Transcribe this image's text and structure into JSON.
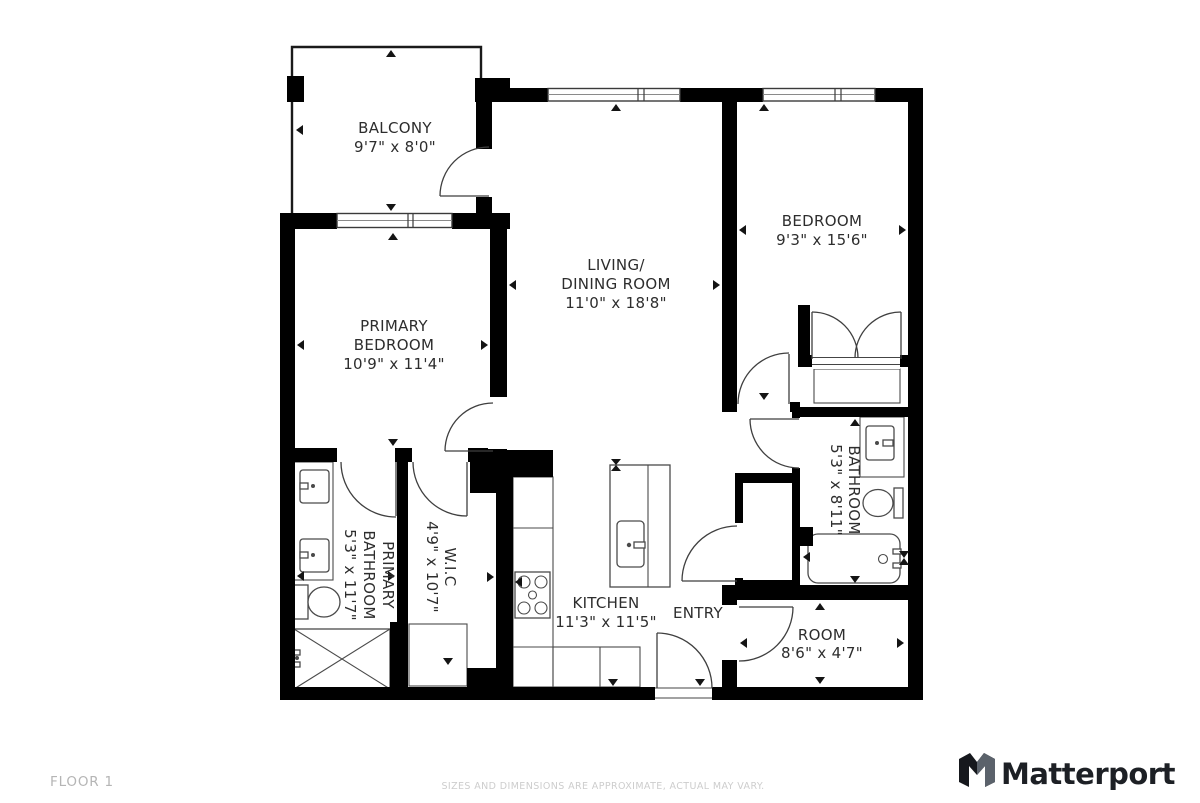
{
  "title": "Floor plan",
  "colors": {
    "background": "#ffffff",
    "wall": "#000000",
    "fixture_line": "#4a4a4a",
    "label": "#2d2d2d",
    "floor_label": "#b5b5b5",
    "disclaimer": "#cdcdcd",
    "brand": "#1d2025"
  },
  "rooms": {
    "balcony": {
      "name": "BALCONY",
      "dims": "9'7\" x 8'0\""
    },
    "primary_bedroom": {
      "line1": "PRIMARY",
      "line2": "BEDROOM",
      "dims": "10'9\" x 11'4\""
    },
    "living_dining": {
      "line1": "LIVING/",
      "line2": "DINING ROOM",
      "dims": "11'0\" x 18'8\""
    },
    "bedroom": {
      "name": "BEDROOM",
      "dims": "9'3\" x 15'6\""
    },
    "bathroom": {
      "name": "BATHROOM",
      "dims": "5'3\" x 8'11\""
    },
    "primary_bathroom": {
      "line1": "PRIMARY",
      "line2": "BATHROOM",
      "dims": "5'3\" x 11'7\""
    },
    "wic": {
      "name": "W.I.C",
      "dims": "4'9\" x 10'7\""
    },
    "kitchen": {
      "name": "KITCHEN",
      "dims": "11'3\" x 11'5\""
    },
    "entry": {
      "name": "ENTRY"
    },
    "room": {
      "name": "ROOM",
      "dims": "8'6\" x 4'7\""
    }
  },
  "footer": {
    "floor_label": "FLOOR 1",
    "disclaimer": "SIZES AND DIMENSIONS ARE APPROXIMATE, ACTUAL MAY VARY.",
    "brand": "Matterport",
    "logo_icon": "matterport-m-icon"
  }
}
